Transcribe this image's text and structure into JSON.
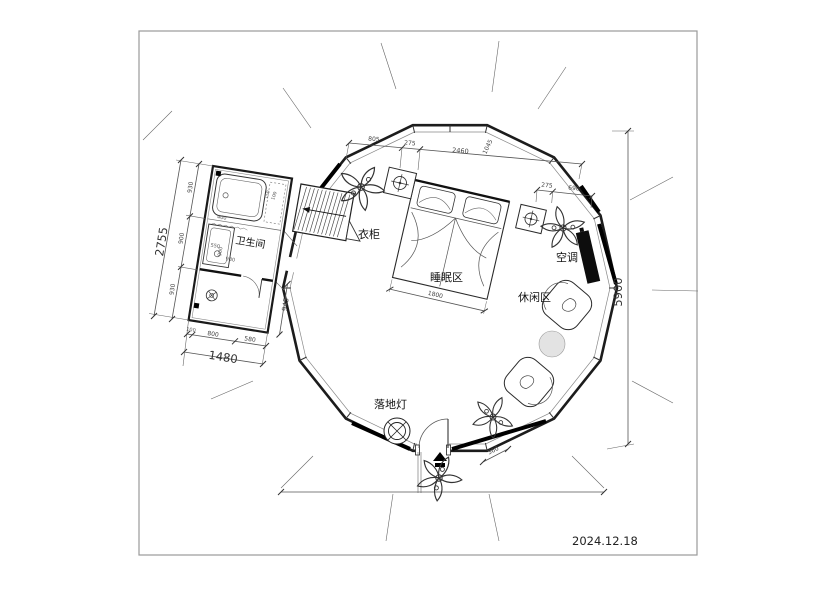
{
  "meta": {
    "date": "2024.12.18"
  },
  "labels": {
    "bathroom": "卫生间",
    "wardrobe": "衣柜",
    "sleeping_area": "睡眠区",
    "leisure_area": "休闲区",
    "air_conditioner": "空调",
    "floor_lamp": "落地灯"
  },
  "dims": {
    "overall_height": "5900",
    "top_chain": [
      "805",
      "275",
      "2460",
      "1045"
    ],
    "right_chain": [
      "275",
      "690"
    ],
    "bed_width": "1800",
    "entry_step": "360",
    "bath_total_height": "2755",
    "bath_left_chain": [
      "930",
      "900",
      "930"
    ],
    "bath_total_width": "1480",
    "bath_bottom_chain": [
      "100",
      "800",
      "580"
    ],
    "bath_corridor": "945",
    "shower_width": "550",
    "tub_width": "400",
    "bath_inner": [
      "900",
      "930"
    ],
    "tub_small": [
      "150",
      "100"
    ]
  }
}
